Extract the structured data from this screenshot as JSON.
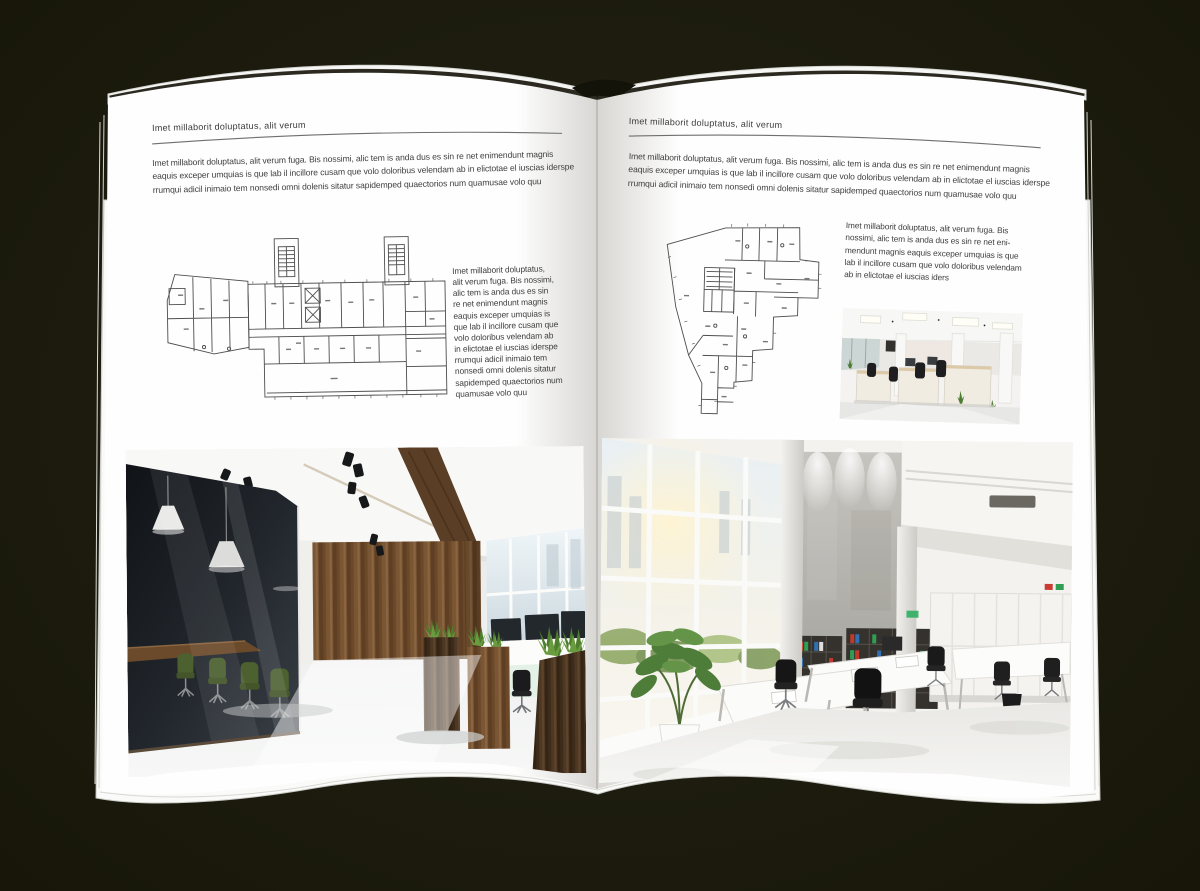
{
  "backdrop_color": "#1d1c10",
  "palette": {
    "page": "#fefefe",
    "text": "#3e3e3e",
    "rule": "#6f6f6f",
    "plan_line": "#4d4d4d",
    "wood": "#75522f",
    "wood_dark": "#4e3824",
    "chair_green": "#4c6030",
    "chair_black": "#1b1b1d",
    "binder_red": "#c0392b",
    "binder_green": "#2f9e52",
    "binder_blue": "#2f6fb2",
    "plant_green": "#4e7d3a"
  },
  "left_page": {
    "header": "Imet millaborit doluptatus, alit verum",
    "intro": "Imet millaborit doluptatus, alit verum fuga. Bis nossimi, alic tem is anda dus es sin re net enimendunt magnis\neaquis exceper umquias is que lab il incillore cusam que volo doloribus velendam ab in elictotae el iuscias iderspe\nrrumqui adicil inimaio tem nonsedi omni dolenis sitatur sapidemped quaectorios num quamusae volo quu",
    "side_text": "Imet millaborit doluptatus,\nalit verum fuga. Bis nossimi,\nalic tem is anda dus es sin\nre net enimendunt magnis\neaquis exceper umquias is\nque lab il incillore cusam que\nvolo doloribus velendam ab\nin elictotae el iuscias iderspe\nrrumqui adicil inimaio tem\nnonsedi omni dolenis sitatur\nsapidemped quaectorios num\nquamusae volo quu",
    "floor_plan_label": "wide-building-floor-plan-drawing",
    "photo_label": "office-interior-glass-meeting-room-wood-wall-photo"
  },
  "right_page": {
    "header": "Imet millaborit doluptatus, alit verum",
    "intro": "Imet millaborit doluptatus, alit verum fuga. Bis nossimi, alic tem is anda dus es sin re net enimendunt magnis\neaquis exceper umquias is que lab il incillore cusam que volo doloribus velendam ab in elictotae el iuscias iderspe\nrrumqui adicil inimaio tem nonsedi omni dolenis sitatur sapidemped quaectorios num quamusae volo quu",
    "side_text": "Imet millaborit doluptatus, alit verum fuga. Bis\nnossimi, alic tem is anda dus es sin re net eni-\nmendunt magnis eaquis exceper umquias is que\nlab il incillore cusam que volo doloribus velendam\nab in elictotae el iuscias iders",
    "floor_plan_label": "irregular-tower-floor-plan-drawing",
    "photo_small_label": "open-office-workstations-photo",
    "photo_large_label": "bright-atrium-office-photo"
  }
}
